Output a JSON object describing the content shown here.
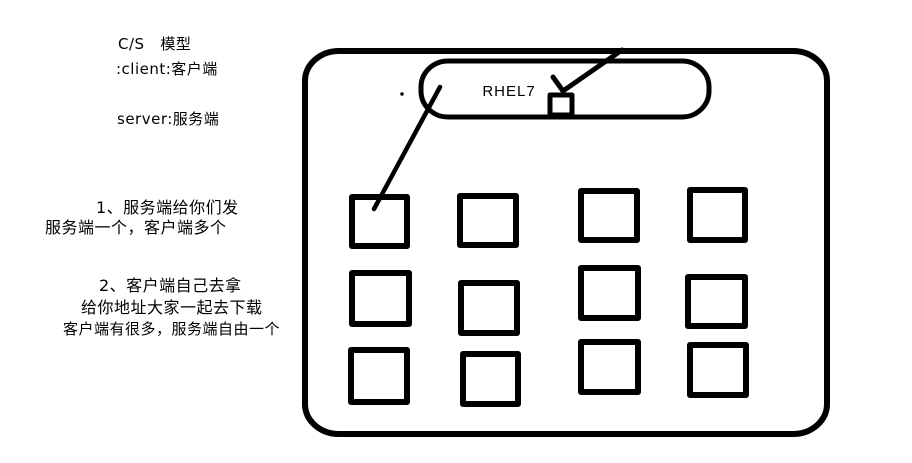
{
  "colors": {
    "ink": "#000000",
    "background": "#ffffff"
  },
  "notes": {
    "title": "C/S   模型",
    "line_client": ":client:客户端",
    "line_server": "server:服务端",
    "point1": {
      "line1": "1、服务端给你们发",
      "line2": "服务端一个，客户端多个"
    },
    "point2": {
      "line1": "2、客户端自己去拿",
      "line2": "给你地址大家一起去下载",
      "line3": "客户端有很多，服务端自由一个"
    }
  },
  "diagram": {
    "os_label": "RHEL7",
    "client_grid": {
      "rows": 3,
      "columns": 4,
      "total_boxes": 12
    }
  }
}
